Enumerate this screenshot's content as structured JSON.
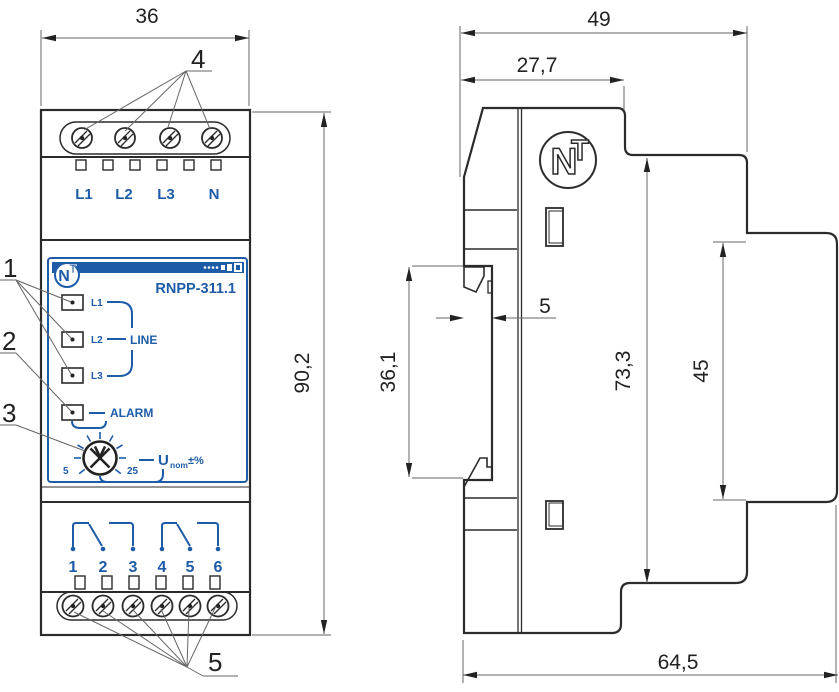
{
  "front_view": {
    "dim_width": "36",
    "dim_height": "90,2",
    "terminals_top": [
      "L1",
      "L2",
      "L3",
      "N"
    ],
    "terminals_bottom": [
      "1",
      "2",
      "3",
      "4",
      "5",
      "6"
    ],
    "face": {
      "model": "RNPP-311.1",
      "logo_n": "N",
      "logo_t": "T",
      "led_labels": [
        "L1",
        "L2",
        "L3"
      ],
      "line_label": "LINE",
      "alarm_label": "ALARM",
      "scale_min": "5",
      "scale_max": "25",
      "u_label": "U",
      "u_sub": "nom",
      "u_suffix": "±%"
    },
    "callouts": {
      "c1": "1",
      "c2": "2",
      "c3": "3",
      "c4": "4",
      "c5": "5"
    }
  },
  "side_view": {
    "logo_n": "N",
    "logo_t": "T",
    "dim_depth_total": "49",
    "dim_depth_front": "27,7",
    "dim_recess_depth": "5",
    "dim_recess_height": "36,1",
    "dim_body_height": "73,3",
    "dim_panel_height": "45",
    "dim_depth_overall": "64,5"
  },
  "colors": {
    "accent_blue": "#1e5ca8",
    "line": "#222222"
  }
}
